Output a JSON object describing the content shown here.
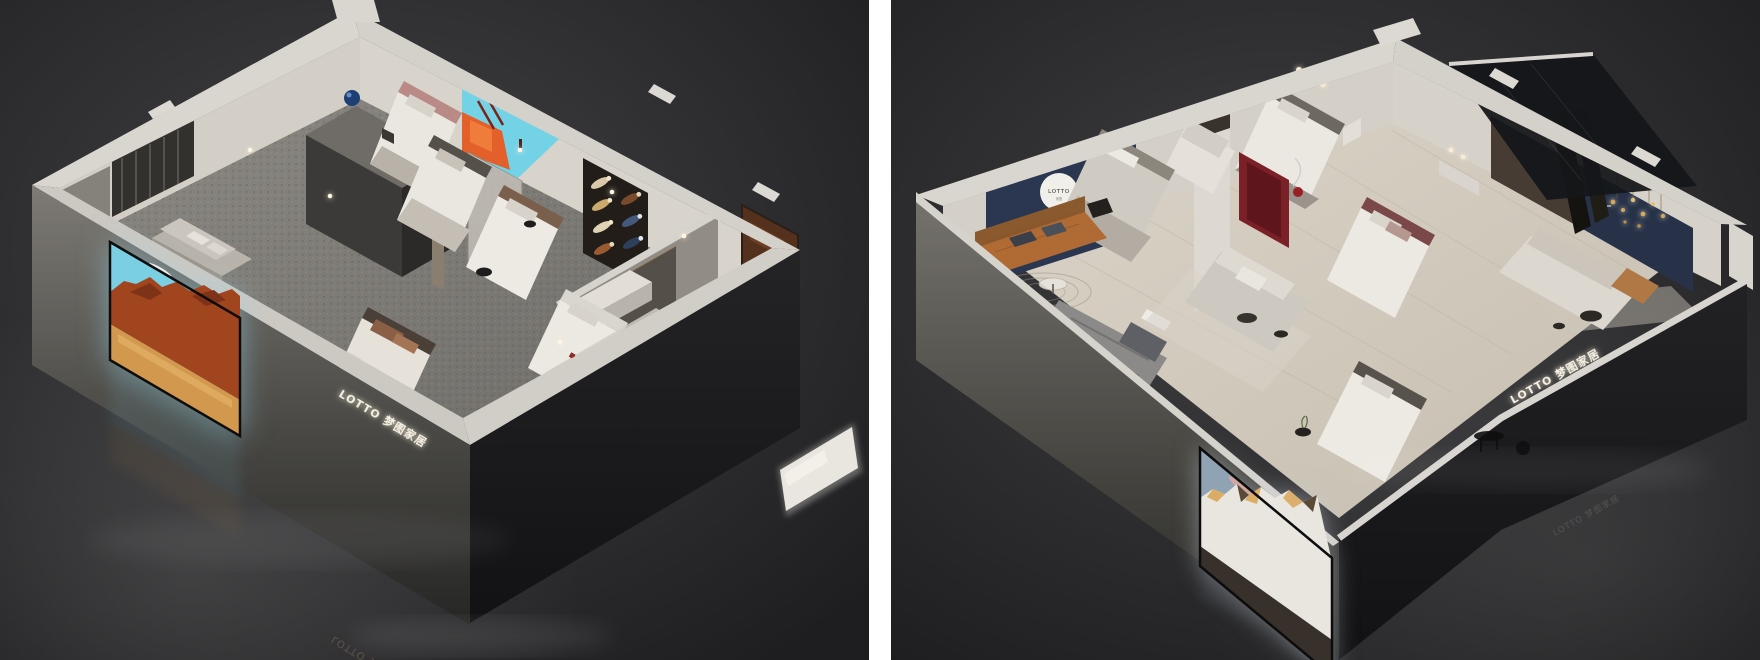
{
  "page": {
    "background": "#ffffff",
    "divider_color": "#ffffff"
  },
  "left_render": {
    "alt": "isometric-cutaway-showroom-render-gray-carpet",
    "brand_sign": "LOTTO 梦图家居",
    "floor_reflection": "LOTTO 梦图家居",
    "palette": {
      "backdrop": "#3a3a3c",
      "wall_top": "#d7d4ce",
      "wall_inner": "#d5d0c8",
      "front_wall": "#6f6c67",
      "carpet": "#86837e",
      "screen_sky": "#7bcfe3",
      "screen_rock": "#a1451f",
      "screen_sand": "#d2994e",
      "mural_sky": "#74d2e6",
      "mural_orange": "#e4602a",
      "sphere_blue": "#1d3f74",
      "art_brown": "#53311d"
    }
  },
  "right_render": {
    "alt": "isometric-cutaway-showroom-render-wood-floor",
    "logo_circle": "LOTTO",
    "logo_circle_sub": "家居",
    "brand_sign": "LOTTO 梦图家居",
    "floor_watermark": "LOTTO 梦图家居",
    "palette": {
      "backdrop": "#39393b",
      "wall_top": "#d7d4ce",
      "wall_inner": "#d4cfc7",
      "floor_wood": "#d8d1c4",
      "accent_navy": "#2b3750",
      "accent_red": "#7c2027",
      "leather_sofa": "#b06a33",
      "screen_sky": "#90a3b4",
      "screen_cloud": "#d9a79f",
      "screen_peak_gold": "#d9a557",
      "chandelier_gold": "#d5a75c"
    }
  }
}
